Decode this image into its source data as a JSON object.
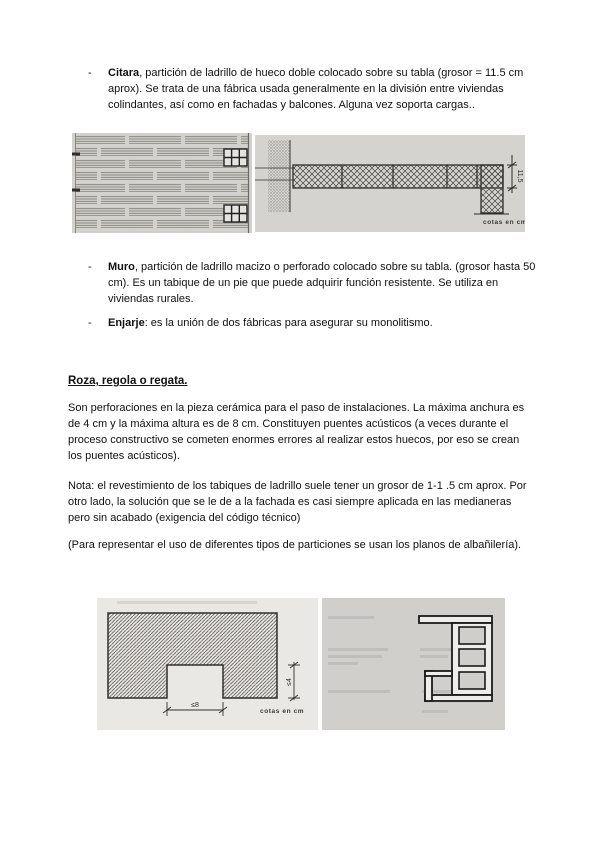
{
  "bullets": {
    "marker": "-",
    "items": [
      {
        "term": "Citara",
        "rest": ", partición de ladrillo de hueco doble colocado sobre su tabla (grosor = 11.5 cm aprox). Se trata de una fábrica usada generalmente en la división entre viviendas colindantes, así como en fachadas y balcones. Alguna vez soporta cargas.."
      },
      {
        "term": "Muro",
        "rest": ", partición de ladrillo macizo o perforado colocado sobre su tabla. (grosor hasta 50 cm). Es un tabique de un pie que puede adquirir función resistente. Se utiliza en viviendas rurales."
      },
      {
        "term": "Enjarje",
        "rest": ": es la unión de dos fábricas para asegurar su monolitismo."
      }
    ]
  },
  "section": {
    "heading": "Roza, regola o regata.",
    "paragraphs": [
      "Son perforaciones en la pieza cerámica para el paso de instalaciones. La máxima anchura es de 4 cm y la máxima altura es de 8 cm. Constituyen puentes acústicos (a veces durante el proceso constructivo se cometen enormes errores al realizar estos huecos, por eso se crean los puentes acústicos).",
      "Nota: el revestimiento de los tabiques de ladrillo suele tener un grosor de 1-1 .5 cm aprox. Por otro lado, la solución que se le de a la fachada es casi siempre aplicada en las medianeras pero sin acabado (exigencia del código técnico)",
      "(Para representar el uso de diferentes tipos de particiones se usan los planos de albañilería)."
    ]
  },
  "figures": {
    "citara_plan": {
      "dimension": "11,5",
      "units": "cotas en cm"
    },
    "roza": {
      "width_dim": "≤8",
      "height_dim": "≤4",
      "units": "cotas en cm"
    }
  }
}
